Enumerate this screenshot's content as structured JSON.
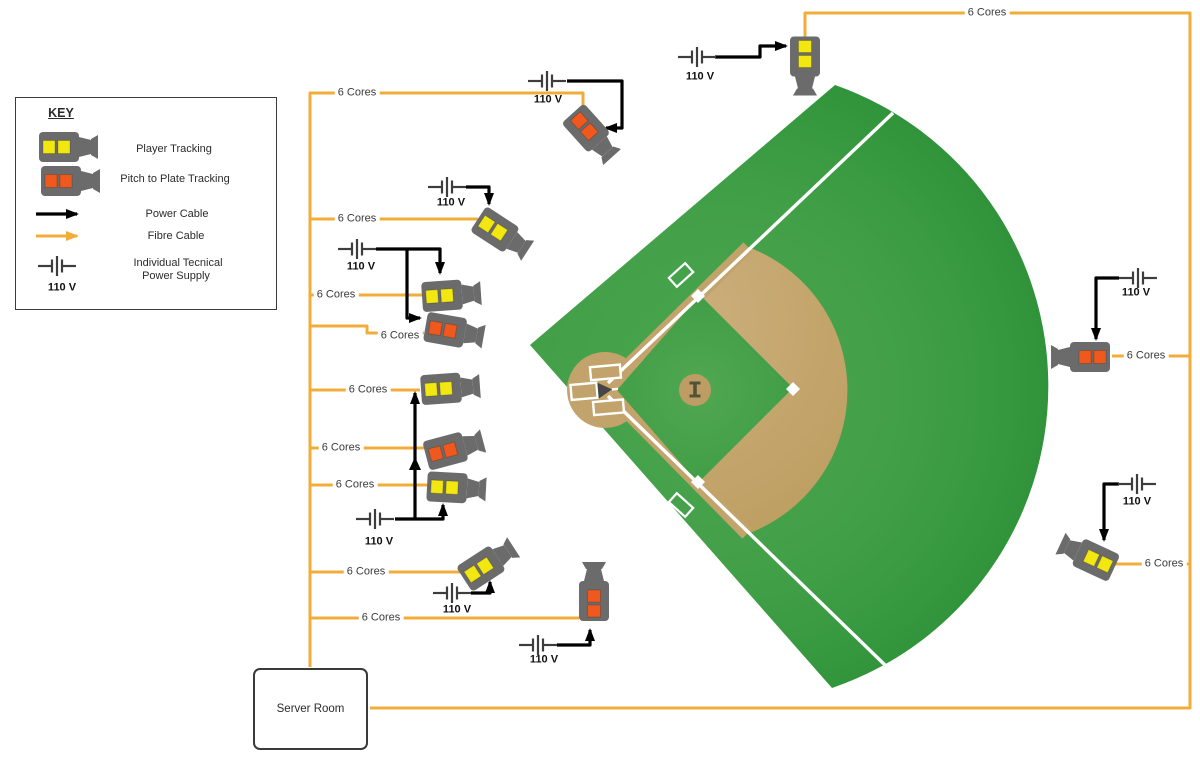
{
  "key": {
    "heading": "KEY",
    "items": [
      {
        "icon": "player-tracking-camera-icon",
        "label": "Player Tracking"
      },
      {
        "icon": "pitch-to-plate-camera-icon",
        "label": "Pitch to Plate Tracking"
      },
      {
        "icon": "power-cable-arrow-icon",
        "label": "Power Cable"
      },
      {
        "icon": "fibre-cable-arrow-icon",
        "label": "Fibre Cable"
      },
      {
        "icon": "individual-power-supply-icon",
        "label_line1": "Individual Tecnical",
        "label_line2": "Power Supply",
        "voltage": "110 V"
      }
    ]
  },
  "labels": {
    "six_cores": "6 Cores",
    "voltage": "110 V"
  },
  "server_room": {
    "label": "Server Room"
  },
  "cameras": [
    {
      "id": 1,
      "type": "Player Tracking"
    },
    {
      "id": 2,
      "type": "Pitch to Plate Tracking"
    },
    {
      "id": 3,
      "type": "Player Tracking"
    },
    {
      "id": 4,
      "type": "Player Tracking"
    },
    {
      "id": 5,
      "type": "Pitch to Plate Tracking"
    },
    {
      "id": 6,
      "type": "Player Tracking"
    },
    {
      "id": 7,
      "type": "Pitch to Plate Tracking"
    },
    {
      "id": 8,
      "type": "Player Tracking"
    },
    {
      "id": 9,
      "type": "Player Tracking"
    },
    {
      "id": 10,
      "type": "Pitch to Plate Tracking"
    },
    {
      "id": 11,
      "type": "Pitch to Plate Tracking"
    },
    {
      "id": 12,
      "type": "Player Tracking"
    }
  ],
  "colors": {
    "fibre_cable": "#F2AC3A",
    "power_cable": "#000000",
    "camera_body": "#6B6B6B",
    "player_tracking_yellow": "#F2E711",
    "pitch_to_plate_orange": "#F0591E",
    "outfield_green": "#3B9A43",
    "infield_dirt": "#C2A36B"
  }
}
